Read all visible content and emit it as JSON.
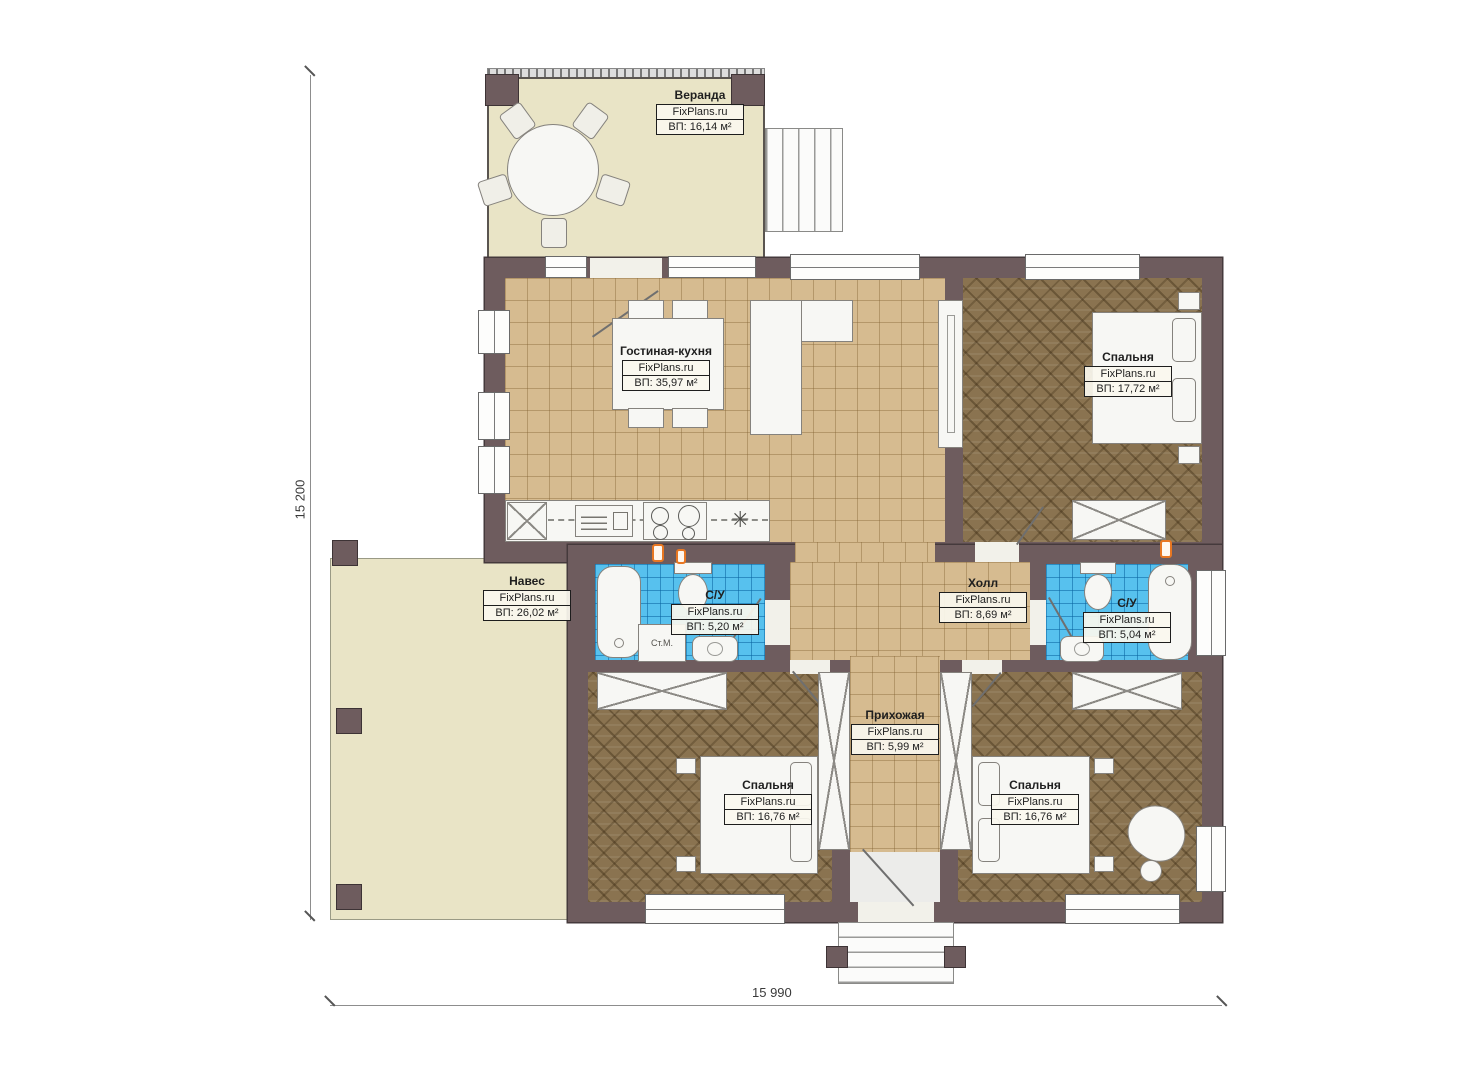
{
  "plan": {
    "brand": "FixPlans.ru",
    "rooms": [
      {
        "id": "veranda",
        "name": "Веранда",
        "area": "ВП: 16,14 м²"
      },
      {
        "id": "living-kitchen",
        "name": "Гостиная-кухня",
        "area": "ВП: 35,97 м²"
      },
      {
        "id": "bedroom-top-right",
        "name": "Спальня",
        "area": "ВП: 17,72 м²"
      },
      {
        "id": "canopy",
        "name": "Навес",
        "area": "ВП: 26,02 м²"
      },
      {
        "id": "bathroom-left",
        "name": "С/У",
        "area": "ВП: 5,20 м²"
      },
      {
        "id": "hall",
        "name": "Холл",
        "area": "ВП: 8,69 м²"
      },
      {
        "id": "bathroom-right",
        "name": "С/У",
        "area": "ВП: 5,04 м²"
      },
      {
        "id": "entry-hall",
        "name": "Прихожая",
        "area": "ВП: 5,99 м²"
      },
      {
        "id": "bedroom-bottom-left",
        "name": "Спальня",
        "area": "ВП: 16,76 м²"
      },
      {
        "id": "bedroom-bottom-right",
        "name": "Спальня",
        "area": "ВП: 16,76 м²"
      }
    ],
    "labels": {
      "washing_machine": "Ст.М."
    },
    "dimensions": {
      "vertical": "15 200",
      "horizontal": "15 990"
    },
    "icons": {
      "vent_star": "✳"
    },
    "colors": {
      "wall": "#6e5c5e",
      "wall_outline": "#453a3c",
      "tile_floor": "#d6bb90",
      "parquet_floor": "#8a7350",
      "bathroom_tile": "#57c1ee",
      "outdoor_beige": "#e9e4c6",
      "furniture": "#f7f7f4",
      "accent_orange": "#e87722",
      "label_border": "#1d1d1d"
    }
  }
}
